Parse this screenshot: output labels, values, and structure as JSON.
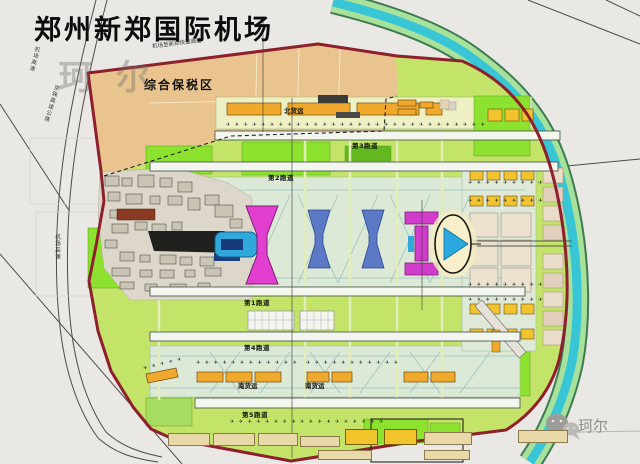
{
  "title": "郑州新郑国际机场",
  "watermarks": {
    "center": "珂尔",
    "corner": "珂尔"
  },
  "zones": {
    "bonded_zone_label": "综合保税区",
    "north_cargo_label": "北货运",
    "south_cargo_label_1": "南货运",
    "south_cargo_label_2": "南货运"
  },
  "runways": [
    {
      "label": "第1跑道"
    },
    {
      "label": "第2跑道"
    },
    {
      "label": "第3跑道"
    },
    {
      "label": "第4跑道"
    },
    {
      "label": "第5跑道"
    }
  ],
  "roads": {
    "airport_expressway_nw": "机场高速",
    "jingzhu_expressway": "京珠高速公路",
    "airport_expressway_w": "机场高速",
    "airport_to_xinzheng_road": "机场至新郑快速通道"
  },
  "icons": {
    "aircraft": "✈",
    "wechat": "wechat-logo"
  },
  "colors": {
    "boundary_red": "#8e1f2c",
    "river_cyan": "#38c6d6",
    "river_green": "#a8e29a",
    "field_green": "#c3e468",
    "bright_green": "#8ce22e",
    "bonded_tan": "#e9c48e",
    "cargo_orange": "#f0a92c",
    "terminal_magenta": "#e23fd0",
    "terminal_blue": "#2fa8dc",
    "satellite_blue": "#5b79c4"
  }
}
